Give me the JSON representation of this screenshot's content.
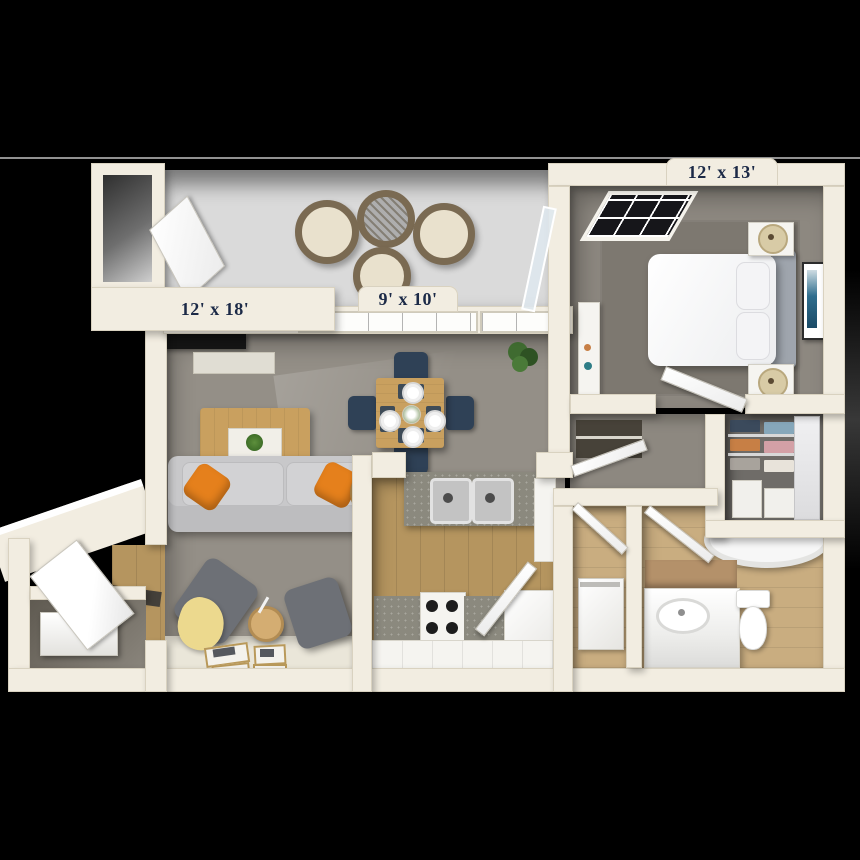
{
  "palette": {
    "background": "#000000",
    "divider": "#919191",
    "wall": "#f2ede1",
    "wallEdge": "#d9d2c0",
    "labelText": "#1c2a47",
    "patioFloor": "#dadada",
    "carpet": "#948f87",
    "bedroomCarpet": "#8d8880",
    "rug": "#7d7870",
    "wood": "#b5955f",
    "woodLight": "#c9ad80",
    "tile": "#eae6d9",
    "sofa": "#c8c8ca",
    "accentOrange": "#e5801c",
    "chairNavy": "#2f4156",
    "tableWood": "#c9a05f",
    "armchair": "#6d7076",
    "throwYellow": "#ecd98e",
    "granite": "#8b897e",
    "appliance": "#f5f4f0",
    "closetDark": "#6f6c68",
    "artBlue": "#2f6e8e",
    "wicker": "#7a6a52",
    "cushion": "#e9e1cd"
  },
  "labels": {
    "bedroom": "12' x 13'",
    "living_room": "12' x 18'",
    "patio": "9' x 10'"
  }
}
